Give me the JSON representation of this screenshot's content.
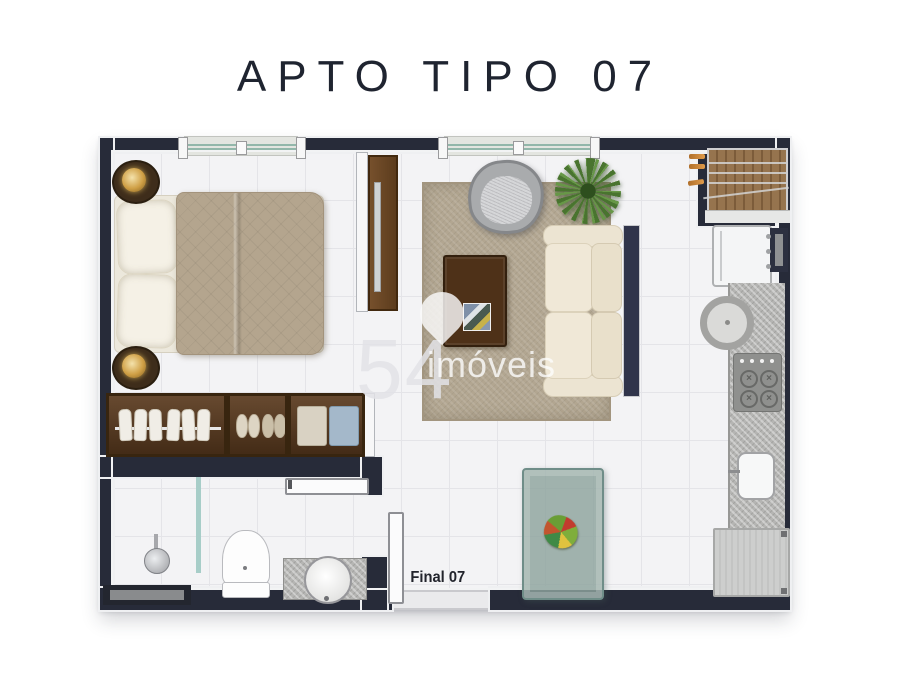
{
  "title": "APTO TIPO 07",
  "unit_label": "Final 07",
  "watermark": {
    "number": "54",
    "name": "imóveis"
  },
  "colors": {
    "wall": "#272b39",
    "floor": "#f3f3f5",
    "rug": "#b2a691",
    "wood_dark": "#4e3118",
    "wood_wardrobe": "#5a3a1e",
    "sofa_cream": "#ece4d2",
    "window_glass": "#92b7aa",
    "dining_glass": "#8da39e",
    "granite": "#b5b5b3",
    "lamp_gold": "#cf9f45",
    "plant_green": "#49742f",
    "clothesline_orange": "#d08a3e"
  },
  "icons": {
    "watermark_pin": "map-pin",
    "stove_burner": "x-cross"
  }
}
